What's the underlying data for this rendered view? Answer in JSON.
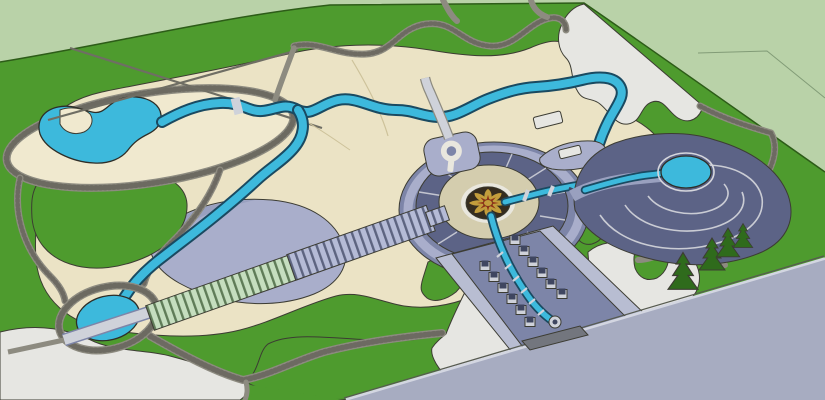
{
  "scene": {
    "title": "park-landscape-master-plan-3d-aerial-render",
    "render_style": "sketchup-model-birdseye",
    "counts": {
      "boulevard_planters": 12,
      "pine_trees": 4,
      "ponds": 3,
      "plaza_radial_lines": 10,
      "spiral_arcs": 3,
      "pergola_segments": 2
    },
    "features": [
      {
        "id": "surrounding-ground",
        "label": "pale surrounding ground plane"
      },
      {
        "id": "park-lawn",
        "label": "main park lawn"
      },
      {
        "id": "gravel-paths",
        "label": "winding gravel paths"
      },
      {
        "id": "west-terrace-pond",
        "label": "kidney pond on oval terrace"
      },
      {
        "id": "meandering-stream",
        "label": "meandering stream"
      },
      {
        "id": "sand-esplanade",
        "label": "sand colored esplanade"
      },
      {
        "id": "lavender-terrace",
        "label": "lavender terrace basin"
      },
      {
        "id": "lawn-island",
        "label": "lawn island"
      },
      {
        "id": "pergola-promenade",
        "label": "striped pergola promenade"
      },
      {
        "id": "oval-pond",
        "label": "oval pond with axis bridge"
      },
      {
        "id": "central-plaza",
        "label": "central circular plaza"
      },
      {
        "id": "mandala-fountain",
        "label": "mandala fountain"
      },
      {
        "id": "keyhole-feature",
        "label": "keyhole pad"
      },
      {
        "id": "spiral-plaza",
        "label": "spiral plaza"
      },
      {
        "id": "spiral-pond",
        "label": "spiral pond"
      },
      {
        "id": "entrance-boulevard",
        "label": "entrance boulevard with water channel"
      },
      {
        "id": "perimeter-road",
        "label": "perimeter road"
      },
      {
        "id": "pine-trees",
        "label": "pine tree cluster"
      },
      {
        "id": "white-paved-plazas",
        "label": "white paved plazas"
      }
    ]
  },
  "colors": {
    "surround": "#b9d2a8",
    "surround_line": "#829c77",
    "lawn": "#4e9b2e",
    "lawn_edge": "#2d5c18",
    "sand": "#ebe3c5",
    "sand_light": "#f0e9cf",
    "sand_curb": "#cdc29a",
    "path_gray": "#8d8b80",
    "path_dot": "#5f5d55",
    "path_thin": "#6f6e64",
    "white_paving": "#e6e6e2",
    "lavender": "#a9aecb",
    "lavender_mid": "#99a0bf",
    "slate": "#7d85a8",
    "slate_dark": "#5c6386",
    "slate_deep": "#3f4660",
    "walk_light": "#cfd2da",
    "walk_band": "#b8bdd2",
    "road": "#a7acc1",
    "road_curb": "#d3d6e1",
    "road_shadow": "#565a50",
    "water": "#3db9dc",
    "water_deep": "#1a4a61",
    "pergola_green": "#c5debf",
    "pergola_green_line": "#5f7c58",
    "pergola_blue": "#b5bbd6",
    "pergola_blue_line": "#5d6480",
    "plaza_inner": "#d4cdae",
    "ring_white": "#e9e7de",
    "ring_line": "#d6d7dd",
    "mandala_gold": "#c29d3c",
    "mandala_red": "#8e3018",
    "mandala_dark": "#352c1e",
    "tree": "#2f6b1c",
    "apron": "#73767e"
  }
}
